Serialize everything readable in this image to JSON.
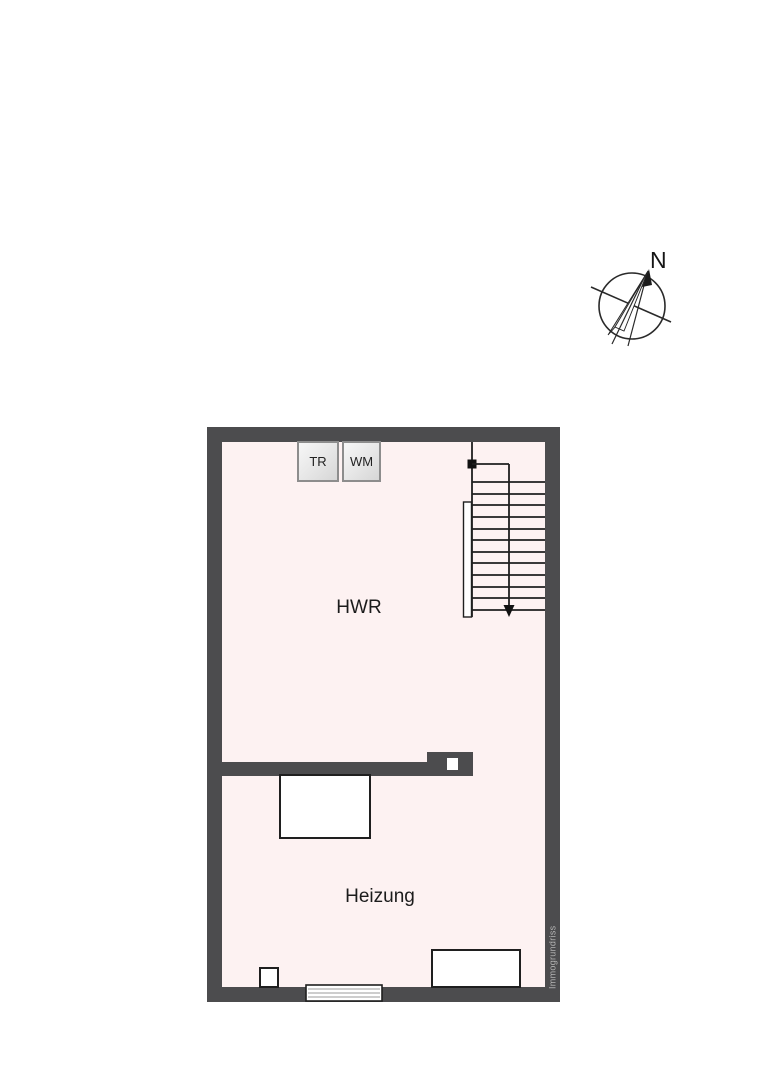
{
  "compass": {
    "north_label": "N"
  },
  "floorplan": {
    "rooms": [
      {
        "name": "HWR"
      },
      {
        "name": "Heizung"
      }
    ],
    "appliances": [
      {
        "label": "TR"
      },
      {
        "label": "WM"
      }
    ],
    "watermark": "Immogrundriss",
    "colors": {
      "wall": "#4c4c4e",
      "floor": "#fdf2f2",
      "line": "#1f1f1f",
      "background": "#ffffff",
      "watermark_text": "#b3b3b3"
    }
  }
}
